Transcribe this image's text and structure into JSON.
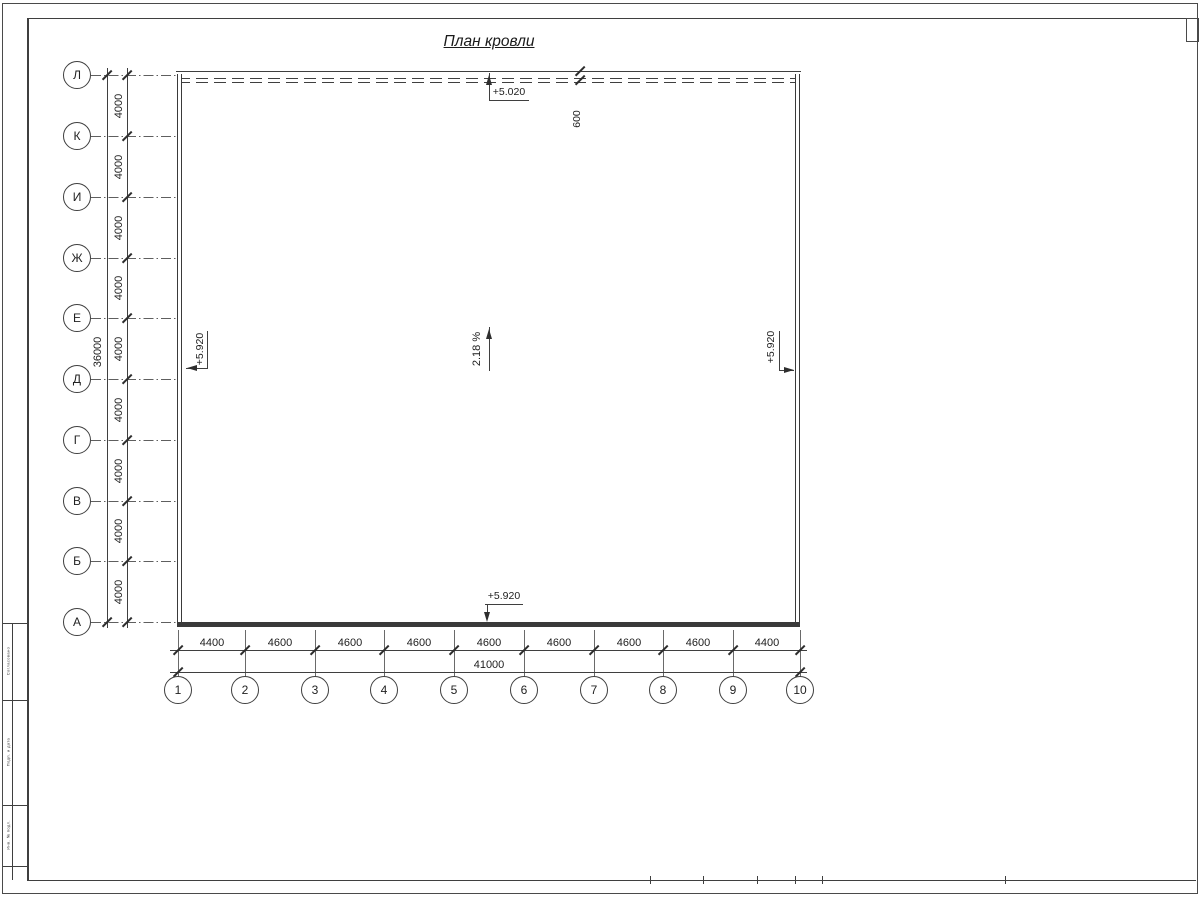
{
  "sheet": {
    "title": "План кровли"
  },
  "axes": {
    "rows": [
      "Л",
      "К",
      "И",
      "Ж",
      "Е",
      "Д",
      "Г",
      "В",
      "Б",
      "А"
    ],
    "cols": [
      "1",
      "2",
      "3",
      "4",
      "5",
      "6",
      "7",
      "8",
      "9",
      "10"
    ]
  },
  "dims": {
    "row_segments": [
      "4000",
      "4000",
      "4000",
      "4000",
      "4000",
      "4000",
      "4000",
      "4000",
      "4000"
    ],
    "row_total": "36000",
    "col_segments": [
      "4400",
      "4600",
      "4600",
      "4600",
      "4600",
      "4600",
      "4600",
      "4600",
      "4400"
    ],
    "col_total": "41000",
    "overhang": "600"
  },
  "marks": {
    "top_elevation": "+5.020",
    "left_elevation": "+5.920",
    "right_elevation": "+5.920",
    "bottom_elevation": "+5.920",
    "slope": "2.18 %"
  },
  "stamp": {
    "labels": [
      "Согласовано",
      "Подп. и дата",
      "Инв. № подл."
    ]
  },
  "colors": {
    "line": "#3f3f3f",
    "paper": "#ffffff"
  }
}
